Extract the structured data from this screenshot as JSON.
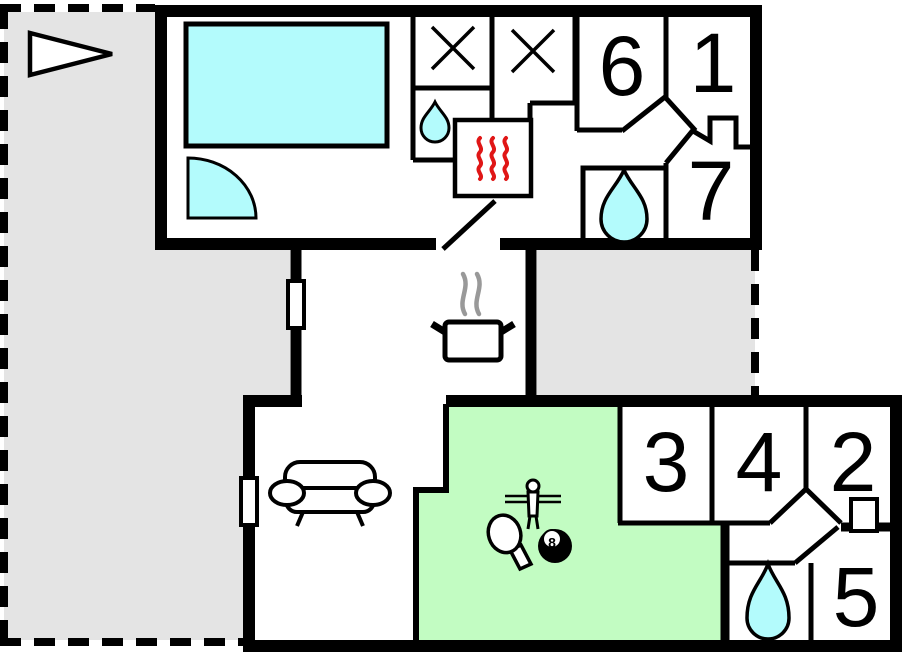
{
  "page": {
    "title": "Holiday house floor plan"
  },
  "colors": {
    "water": "#b3fbfc",
    "games_room": "#c2fcc2",
    "terrace": "#e4e4e4",
    "heater_red": "#e01616",
    "steam_gray": "#999999",
    "wall": "#000000",
    "background": "#ffffff"
  },
  "rooms": [
    {
      "number": "1",
      "x": 713,
      "y": 63
    },
    {
      "number": "2",
      "x": 853,
      "y": 462
    },
    {
      "number": "3",
      "x": 666,
      "y": 462
    },
    {
      "number": "4",
      "x": 759,
      "y": 462
    },
    {
      "number": "5",
      "x": 856,
      "y": 597
    },
    {
      "number": "6",
      "x": 622,
      "y": 66
    },
    {
      "number": "7",
      "x": 711,
      "y": 191
    }
  ],
  "labels": {
    "billiard_ball": "8"
  },
  "icons": [
    {
      "name": "north-arrow",
      "x": 71,
      "y": 54
    },
    {
      "name": "pool",
      "x": 286,
      "y": 85
    },
    {
      "name": "corner-bath",
      "x": 188,
      "y": 218
    },
    {
      "name": "burner-x-left",
      "x": 453,
      "y": 48
    },
    {
      "name": "burner-x-right",
      "x": 533,
      "y": 51
    },
    {
      "name": "washbasin-droplet",
      "x": 435,
      "y": 122
    },
    {
      "name": "sauna-heater",
      "x": 493,
      "y": 158
    },
    {
      "name": "shower-droplet",
      "x": 624,
      "y": 206
    },
    {
      "name": "cooking-pot",
      "x": 473,
      "y": 340
    },
    {
      "name": "sofa",
      "x": 330,
      "y": 494
    },
    {
      "name": "table-tennis-paddle",
      "x": 508,
      "y": 538
    },
    {
      "name": "foosball-player",
      "x": 533,
      "y": 500
    },
    {
      "name": "billiard-8-ball",
      "x": 555,
      "y": 546
    },
    {
      "name": "bath-droplet",
      "x": 768,
      "y": 602
    }
  ]
}
